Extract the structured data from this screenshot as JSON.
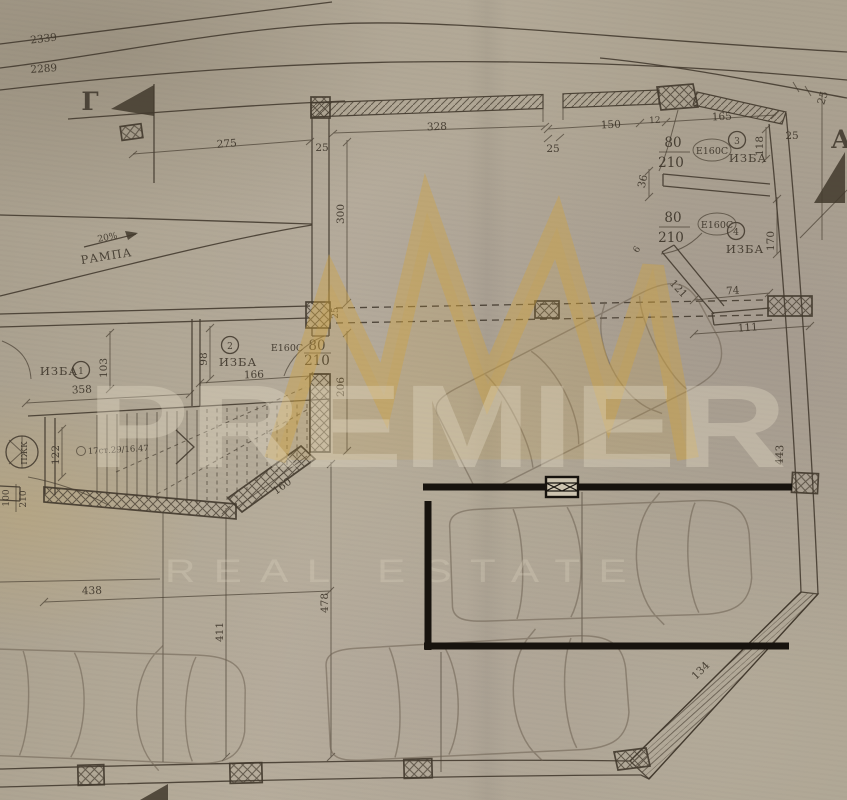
{
  "canvas": {
    "width": 847,
    "height": 800
  },
  "palette": {
    "paper": "#b3a996",
    "ink": "#42392d",
    "gold": "#d0a33e",
    "highlight": "#17130e"
  },
  "contours": {
    "upper": "2339",
    "lower": "2289"
  },
  "sections": {
    "left": "Г",
    "right": "А"
  },
  "ramp": {
    "slope": "20%",
    "label": "РАМПА"
  },
  "rooms": {
    "izba": "ИЗБА",
    "fire_rating": "Е160С",
    "door_w": "80",
    "door_h": "210",
    "door1_w": "100",
    "n1": "1",
    "n2": "2",
    "n3": "3",
    "n4": "4"
  },
  "stairs": {
    "note": "17ст.29/16.47",
    "shaft": "ПЖК"
  },
  "dims": {
    "d6": "6",
    "d12": "12",
    "d25": "25",
    "d36": "36",
    "d74": "74",
    "d98": "98",
    "d103": "103",
    "d111": "111",
    "d118": "118",
    "d121": "121",
    "d122": "122",
    "d134": "134",
    "d150": "150",
    "d160": "160",
    "d165": "165",
    "d166": "166",
    "d170": "170",
    "d206": "206",
    "d275": "275",
    "d300": "300",
    "d328": "328",
    "d358": "358",
    "d411": "411",
    "d438": "438",
    "d443": "443",
    "d478": "478"
  },
  "watermark": {
    "brand": "PREMIER",
    "subtitle": "REAL ESTATE"
  }
}
